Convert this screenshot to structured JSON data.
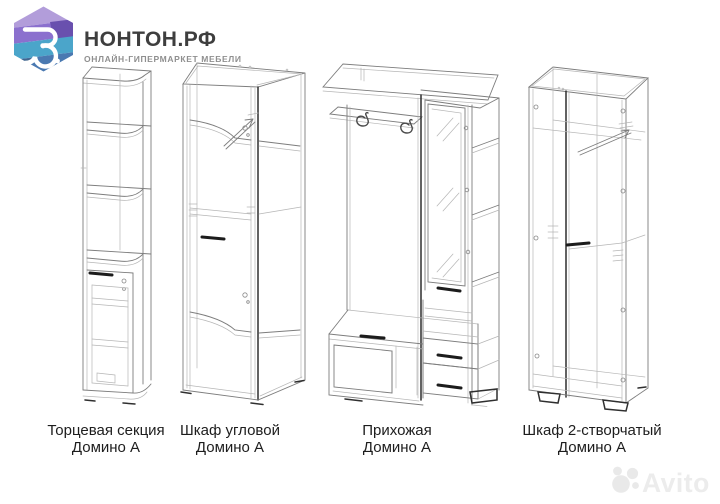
{
  "page": {
    "background": "#ffffff"
  },
  "header": {
    "brand": "НОНТОН.РФ",
    "tagline": "ОНЛАЙН-ГИПЕРМАРКЕТ МЕБЕЛИ",
    "logo": {
      "glyph_color": "#ffffff",
      "colors": {
        "band1": "#b29dda",
        "band2": "#8b70ce",
        "band2b": "#6950ae",
        "band3": "#4ba5ca",
        "band4": "#4a79b1",
        "band4b": "#42678f"
      }
    }
  },
  "products": [
    {
      "name": "Торцевая секция",
      "series": "Домино А"
    },
    {
      "name": "Шкаф угловой",
      "series": "Домино А"
    },
    {
      "name": "Прихожая",
      "series": "Домино А"
    },
    {
      "name": "Шкаф 2-створчатый",
      "series": "Домино А"
    }
  ],
  "drawing": {
    "line_color": "#7d7d7d",
    "faint_color": "#b6b6b6",
    "accent_color": "#2f2f2f",
    "handle_color": "#1c1c1c"
  },
  "watermark": {
    "text": "Avito",
    "color": "#e9e9e9"
  }
}
